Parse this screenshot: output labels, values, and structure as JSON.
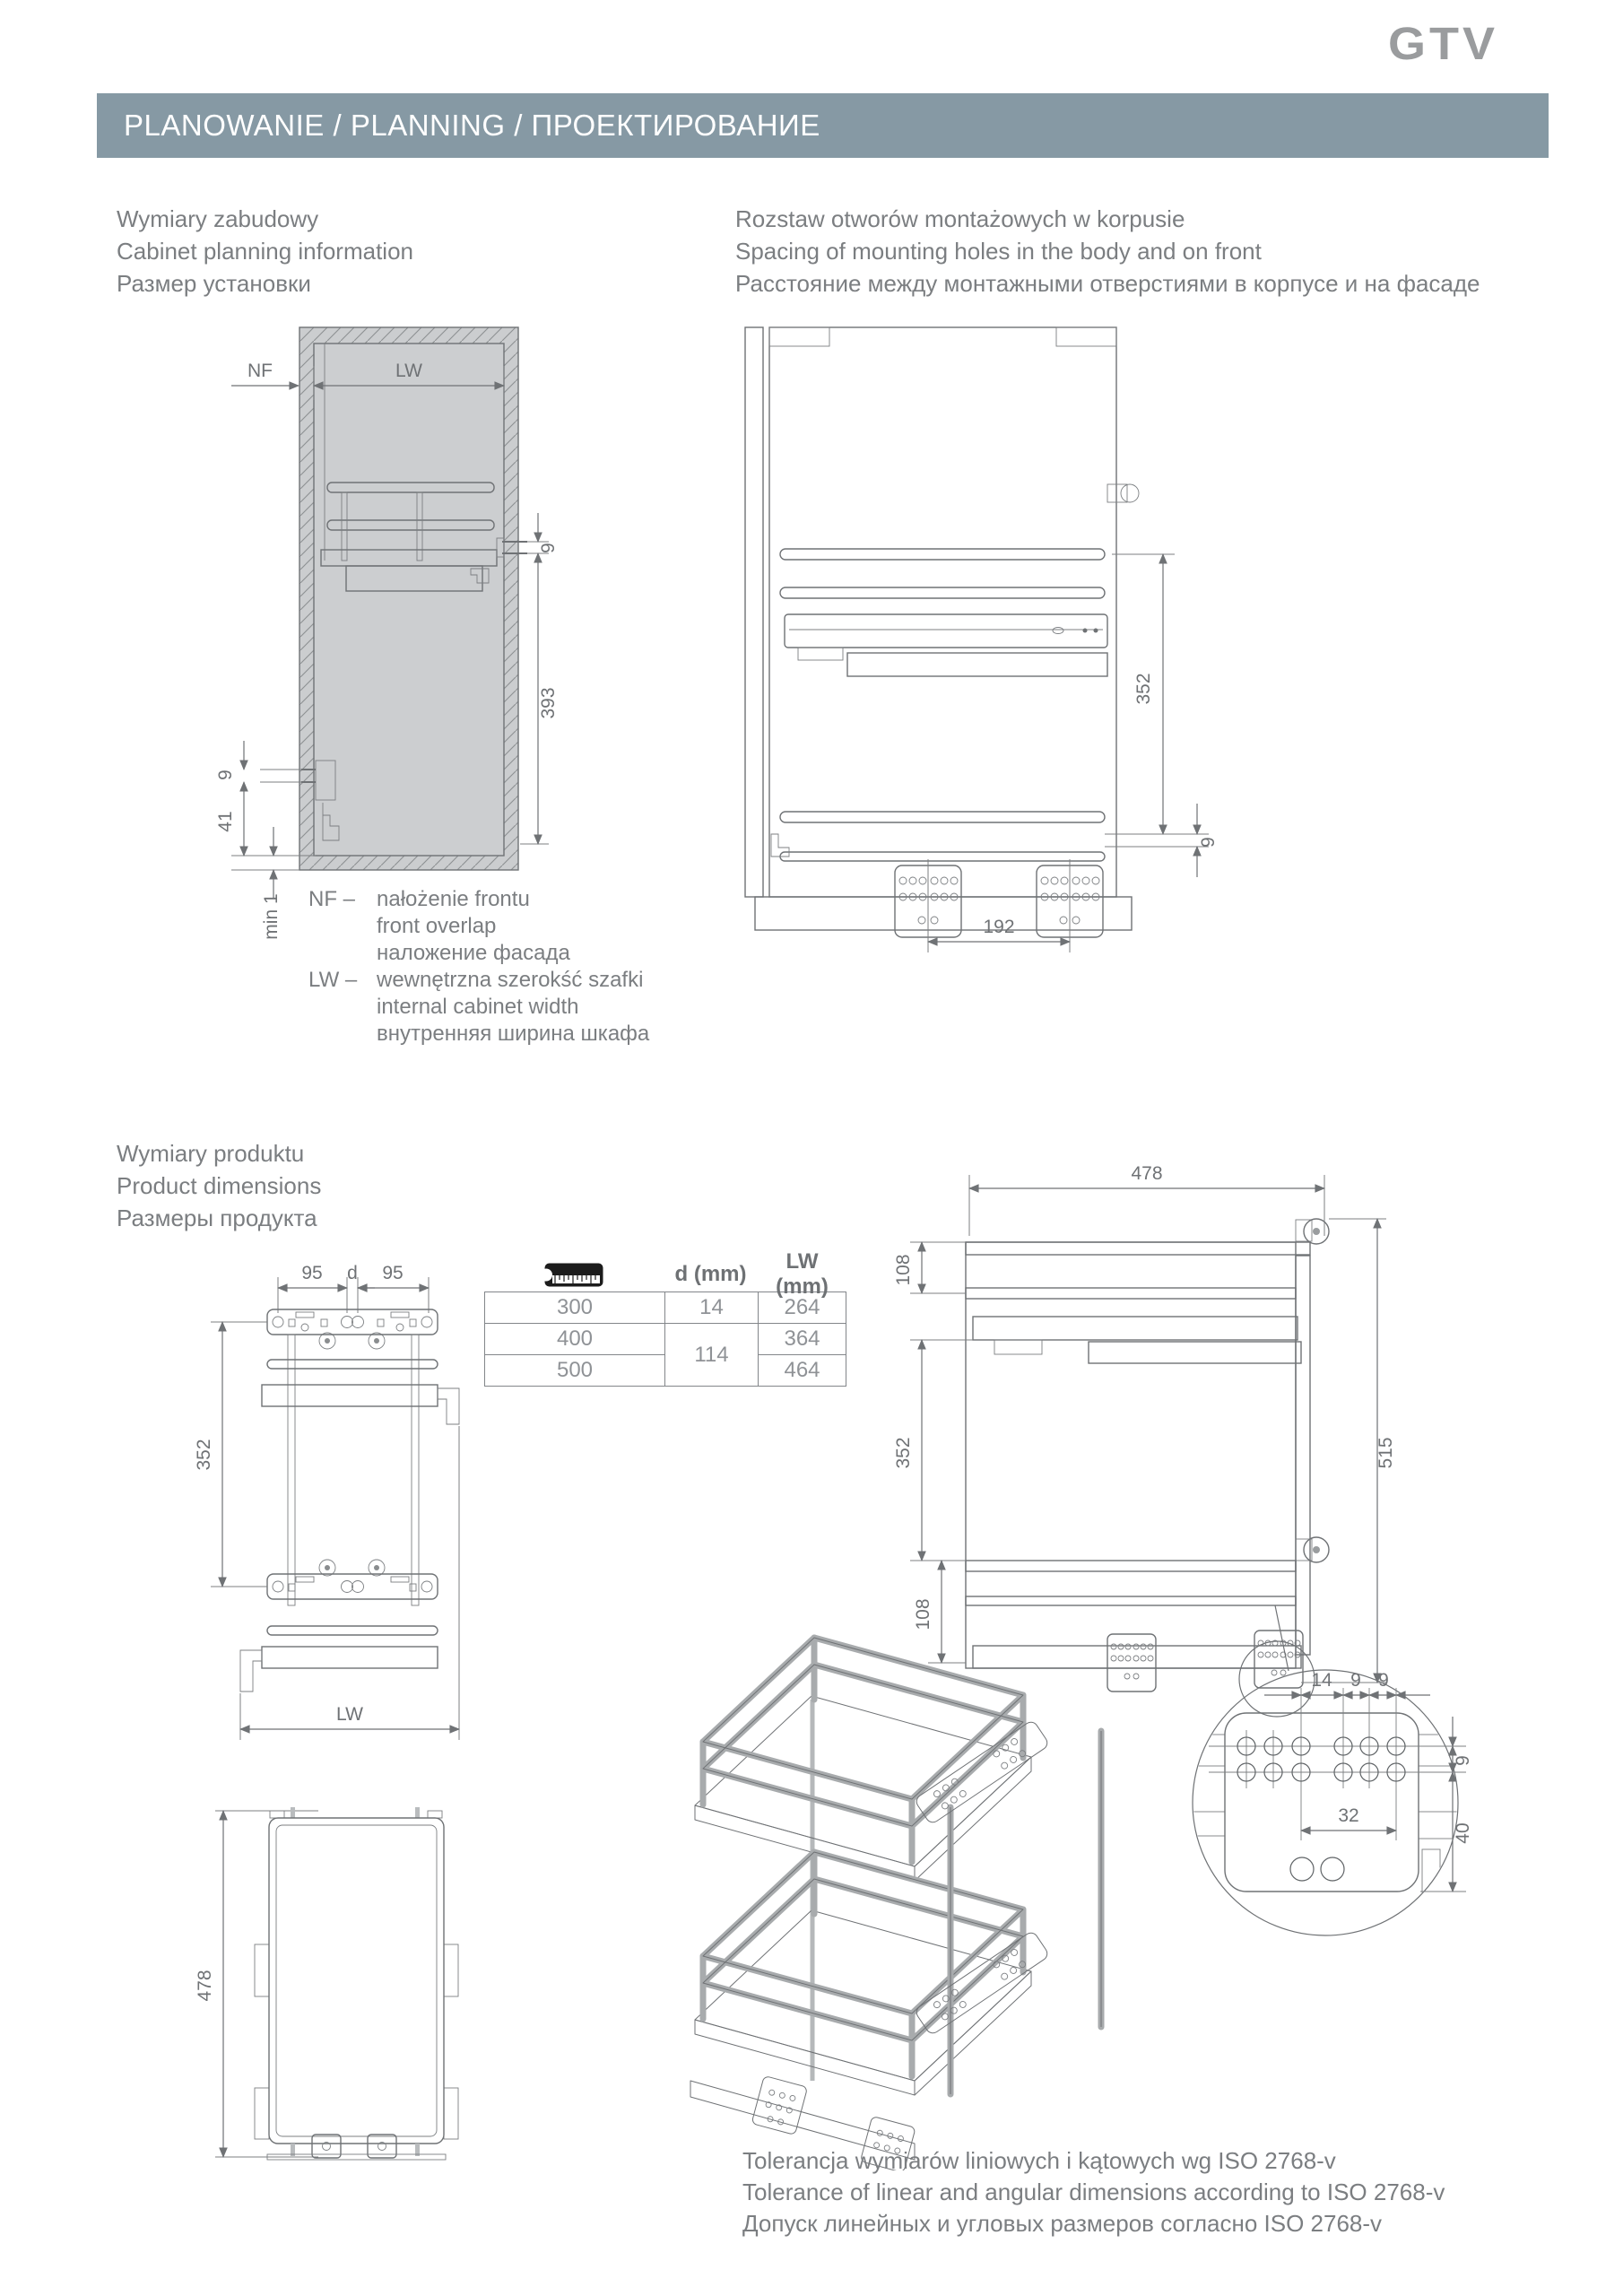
{
  "logo": "GTV",
  "header": {
    "title": "PLANOWANIE / PLANNING / ПРОЕКТИРОВАНИЕ"
  },
  "headings": {
    "cabinet": [
      "Wymiary zabudowy",
      "Cabinet planning information",
      "Размер установки"
    ],
    "holes": [
      "Rozstaw otworów montażowych w korpusie",
      "Spacing of mounting holes in the body and on front",
      "Расстояние между монтажными отверстиями в корпусе и на фасаде"
    ],
    "product": [
      "Wymiary produktu",
      "Product dimensions",
      "Размеры продукта"
    ]
  },
  "legend": {
    "nf_abbr": "NF –",
    "nf_lines": [
      "nałożenie frontu",
      "front overlap",
      "наложение фасада"
    ],
    "lw_abbr": "LW –",
    "lw_lines": [
      "wewnętrzna szerokść szafki",
      "internal cabinet width",
      "внутренняя ширина шкафа"
    ]
  },
  "tolerance": [
    "Tolerancja wymiarów liniowych i kątowych wg ISO 2768-v",
    "Tolerance of linear and angular dimensions according to ISO 2768-v",
    "Допуск линейных и угловых размеров согласно ISO 2768-v"
  ],
  "table": {
    "col_icon": "ruler-icon",
    "col_d": "d (mm)",
    "col_lw": "LW (mm)",
    "rows": [
      {
        "w": "300",
        "d": "14",
        "lw": "264"
      },
      {
        "w": "400",
        "d": "114",
        "lw": "364"
      },
      {
        "w": "500",
        "lw": "464"
      }
    ]
  },
  "dims": {
    "cab": {
      "nf": "NF",
      "lw": "LW",
      "d9r": "9",
      "d393": "393",
      "d9l": "9",
      "d41": "41",
      "min1": "min 1"
    },
    "holes": {
      "d352": "352",
      "d9": "9",
      "d192": "192"
    },
    "top": {
      "d95a": "95",
      "dd": "d",
      "d95b": "95",
      "d352": "352",
      "lw": "LW"
    },
    "side": {
      "d478": "478",
      "d108a": "108",
      "d352": "352",
      "d108b": "108",
      "d515": "515"
    },
    "detail": {
      "d14": "14",
      "d9a": "9",
      "d9b": "9",
      "d9r": "9",
      "d40": "40",
      "d32": "32"
    },
    "tray": {
      "d478": "478"
    }
  },
  "colors": {
    "header_bg": "#8699a4",
    "text_gray": "#7b7e81",
    "line_gray": "#6f7275"
  }
}
